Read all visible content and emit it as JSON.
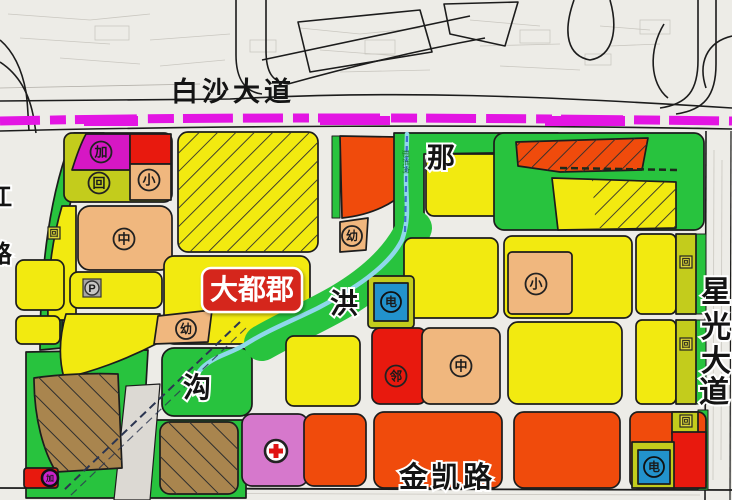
{
  "roads": {
    "baisha": "白沙大道",
    "jinkai": "金凯路",
    "xingguang": [
      "星",
      "光",
      "大",
      "道"
    ],
    "left_partial": [
      "江",
      "路"
    ]
  },
  "stream": {
    "na": "那",
    "hong": "洪",
    "gou": "沟",
    "corridor_label": "那洪沟"
  },
  "project": {
    "name": "大都郡"
  },
  "hospital_icon": "red-cross",
  "badges": [
    {
      "name": "gas-station",
      "char": "加"
    },
    {
      "name": "resettlement",
      "char": "回"
    },
    {
      "name": "primary-school",
      "char": "小"
    },
    {
      "name": "middle-school",
      "char": "中"
    },
    {
      "name": "resettlement-small",
      "char": "回"
    },
    {
      "name": "parking",
      "char": "P"
    },
    {
      "name": "kindergarten",
      "char": "幼"
    },
    {
      "name": "kindergarten-2",
      "char": "幼"
    },
    {
      "name": "substation",
      "char": "电"
    },
    {
      "name": "neighborhood-center",
      "char": "邻"
    },
    {
      "name": "middle-school-2",
      "char": "中"
    },
    {
      "name": "primary-school-2",
      "char": "小"
    },
    {
      "name": "gas-station-2",
      "char": "加"
    },
    {
      "name": "substation-2",
      "char": "电"
    },
    {
      "name": "resettlement-strip-1",
      "char": "回"
    },
    {
      "name": "resettlement-strip-2",
      "char": "回"
    },
    {
      "name": "resettlement-strip-3",
      "char": "回"
    }
  ],
  "colors": {
    "residential_yellow": "#f2ea10",
    "mixed_olive": "#c3cc1c",
    "green_space": "#28c33e",
    "school_tan": "#f0b77e",
    "commercial_red": "#e8190e",
    "orange": "#f04b0c",
    "magenta_zone": "#d617c4",
    "village_brown": "#a9854e",
    "hospital_pink": "#d678cc",
    "utility_blue": "#2292cc",
    "metro_dash_magenta": "#e315e3",
    "stream_blue": "#8fd8ea",
    "road_gray": "#dcd9d3",
    "label_red_box": "#d5251b"
  }
}
